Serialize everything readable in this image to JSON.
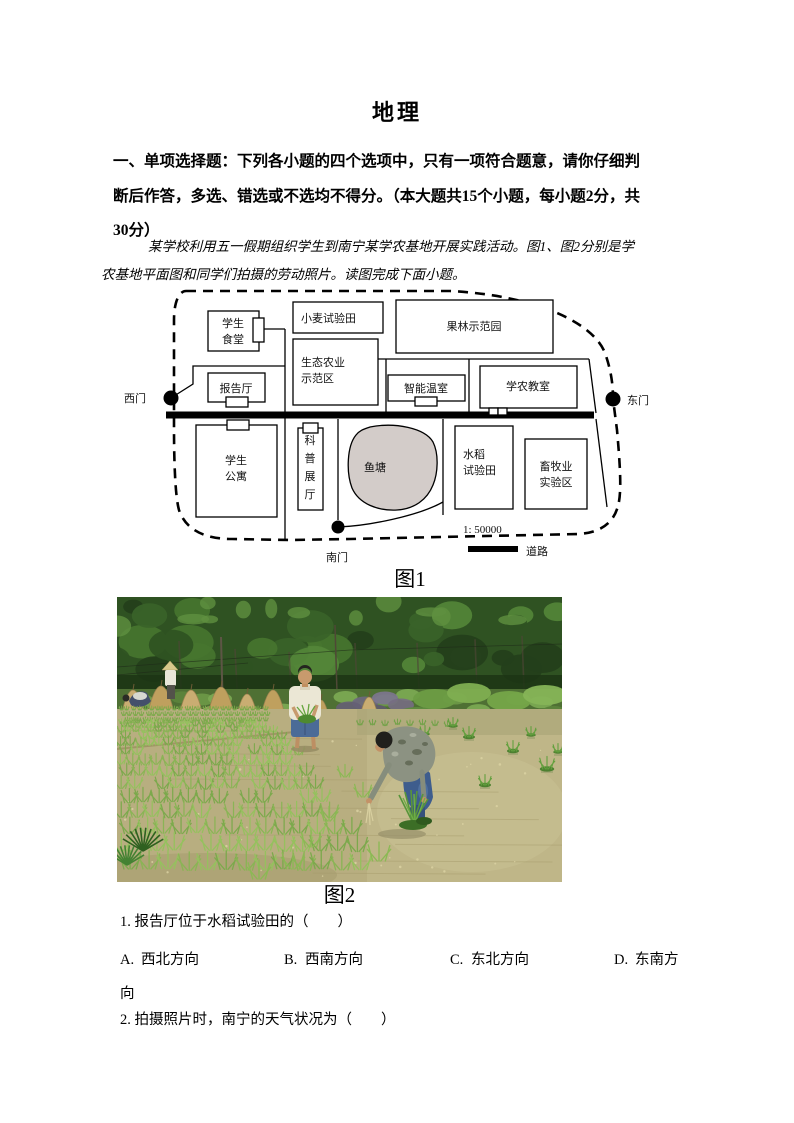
{
  "page": {
    "title": "地理",
    "instructions": "一、单项选择题：下列各小题的四个选项中，只有一项符合题意，请你仔细判断后作答，多选、错选或不选均不得分。（本大题共15个小题，每小题2分，共30分）",
    "intro": "某学校利用五一假期组织学生到南宁某学农基地开展实践活动。图1、图2分别是学农基地平面图和同学们拍摄的劳动照片。读图完成下面小题。",
    "figure1_caption": "图1",
    "figure2_caption": "图2"
  },
  "map": {
    "gates": [
      {
        "id": "west",
        "label": "西门"
      },
      {
        "id": "east",
        "label": "东门"
      },
      {
        "id": "south",
        "label": "南门"
      }
    ],
    "buildings": [
      {
        "id": "canteen",
        "label": "学生\n食堂"
      },
      {
        "id": "wheat-field",
        "label": "小麦试验田"
      },
      {
        "id": "orchard",
        "label": "果林示范园"
      },
      {
        "id": "eco-agri",
        "label": "生态农业\n示范区"
      },
      {
        "id": "lecture-hall",
        "label": "报告厅"
      },
      {
        "id": "greenhouse",
        "label": "智能温室"
      },
      {
        "id": "farm-classroom",
        "label": "学农教室"
      },
      {
        "id": "dorm",
        "label": "学生\n公寓"
      },
      {
        "id": "science-hall",
        "label": "科普展厅"
      },
      {
        "id": "rice-field",
        "label": "水稻\n试验田"
      },
      {
        "id": "livestock",
        "label": "畜牧业\n实验区"
      }
    ],
    "pond_label": "鱼塘",
    "pond_color": "#d3ccc9",
    "scale_text": "1: 50000",
    "legend_road_label": "道路"
  },
  "photo": {
    "description": "劳动照片：同学们在南宁学农基地的水田中插秧，背景为树林与草垛，田中有浑浊的黄泥水和成行的绿色秧苗",
    "palette": {
      "forest_green": "#2f5222",
      "paddy_water_tan": "#b8ae80",
      "seedling_green": "#8ab455",
      "haystack_tan": "#c9ad72"
    }
  },
  "questions": [
    {
      "number": "1.",
      "stem": "报告厅位于水稻试验田的（　　）",
      "options": [
        {
          "label": "A.",
          "text": "西北方向"
        },
        {
          "label": "B.",
          "text": "西南方向"
        },
        {
          "label": "C.",
          "text": "东北方向"
        },
        {
          "label": "D.",
          "text": "东南方向"
        }
      ]
    },
    {
      "number": "2.",
      "stem": "拍摄照片时，南宁的天气状况为（　　）"
    }
  ]
}
